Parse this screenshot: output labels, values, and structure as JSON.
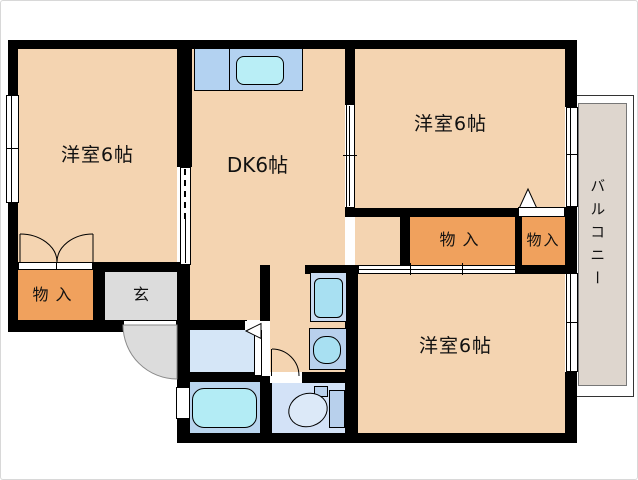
{
  "floorplan": {
    "labels": {
      "bedroom_tl": "洋室6帖",
      "bedroom_tr": "洋室6帖",
      "bedroom_br": "洋室6帖",
      "dining_kitchen": "DK6帖",
      "balcony": "バルコニー",
      "storage_bl": "物入",
      "storage_mid": "物入",
      "storage_r": "物入",
      "entrance": "玄"
    },
    "colors": {
      "room": "#f4d4b1",
      "closet": "#f0a15d",
      "entrance": "#dcdcdc",
      "balcony": "#ded6ce",
      "wall": "#000000",
      "counter": "#b3d2f1",
      "sink": "#b9eef6",
      "washroom": "#d5e6f7",
      "bath": "#b9d5ee",
      "tub": "#b3ecf5",
      "toilet_room": "#d3e2f7",
      "fixture": "#b8d0ec",
      "washer": "#a8e0f2",
      "washer_pan": "#c8dbf2",
      "toilet_bowl": "#dce9f8"
    }
  }
}
